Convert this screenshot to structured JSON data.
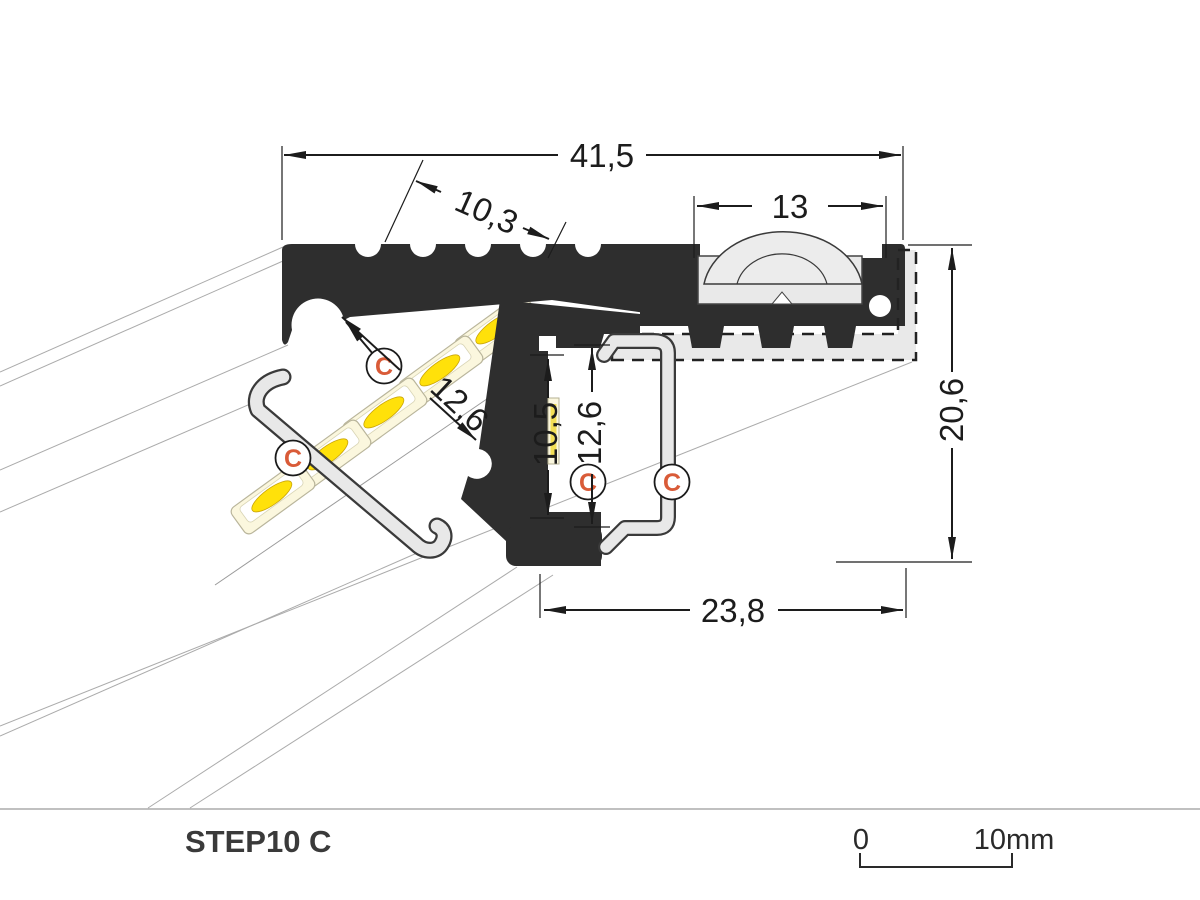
{
  "page": {
    "background": "#ffffff"
  },
  "drawing": {
    "type": "technical-cross-section",
    "description": "LED stair-nosing aluminium profile cross section with dimensions",
    "dimensions": {
      "total_width": "41,5",
      "groove_section": "10,3",
      "lens_width": "13",
      "total_height": "20,6",
      "diagonal_channel": "12,6",
      "channel_inner_height": "10,5",
      "cover_height": "12,6",
      "bottom_width": "23,8"
    },
    "markers": {
      "symbol": "C",
      "count": 4
    },
    "colors": {
      "profile_black": "#2e2e2e",
      "cover_gray": "#e8e8e8",
      "led_body": "#fbf7de",
      "led_chip": "#ffe10a",
      "marker_accent": "#d95b38",
      "dimension_ink": "#1c1c1c"
    }
  },
  "footer": {
    "product_label": "STEP10 C",
    "scale_start": "0",
    "scale_end": "10mm"
  }
}
